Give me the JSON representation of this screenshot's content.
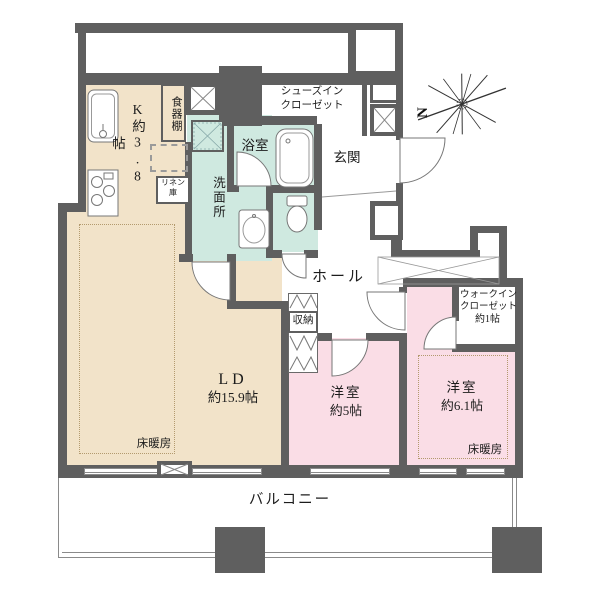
{
  "compass": {
    "north_label": "N"
  },
  "rooms": {
    "kitchen": {
      "label": "K約3.8帖"
    },
    "dish_cabinet": {
      "label": "食器棚"
    },
    "linen_closet": {
      "line1": "リネン",
      "line2": "庫"
    },
    "shoes_in_closet": {
      "line1": "シューズイン",
      "line2": "クローゼット"
    },
    "bathroom": {
      "label": "浴室"
    },
    "washroom": {
      "label": "洗面所"
    },
    "entrance": {
      "label": "玄関"
    },
    "hall": {
      "label": "ホール"
    },
    "storage": {
      "label": "収納"
    },
    "living_dining": {
      "name": "LD",
      "size": "約15.9帖",
      "floor_heating": "床暖房"
    },
    "bedroom_5": {
      "name": "洋室",
      "size": "約5帖"
    },
    "bedroom_6_1": {
      "name": "洋室",
      "size": "約6.1帖",
      "floor_heating": "床暖房"
    },
    "walk_in_closet": {
      "line1": "ウォークイン",
      "line2": "クローゼット",
      "size": "約1帖"
    },
    "balcony": {
      "label": "バルコニー"
    }
  },
  "colors": {
    "wall": "#5f5f5f",
    "room_beige": "#f2e3c9",
    "room_pink": "#fadde6",
    "room_teal": "#cfe9e0",
    "outline": "#777777",
    "background": "#ffffff"
  }
}
